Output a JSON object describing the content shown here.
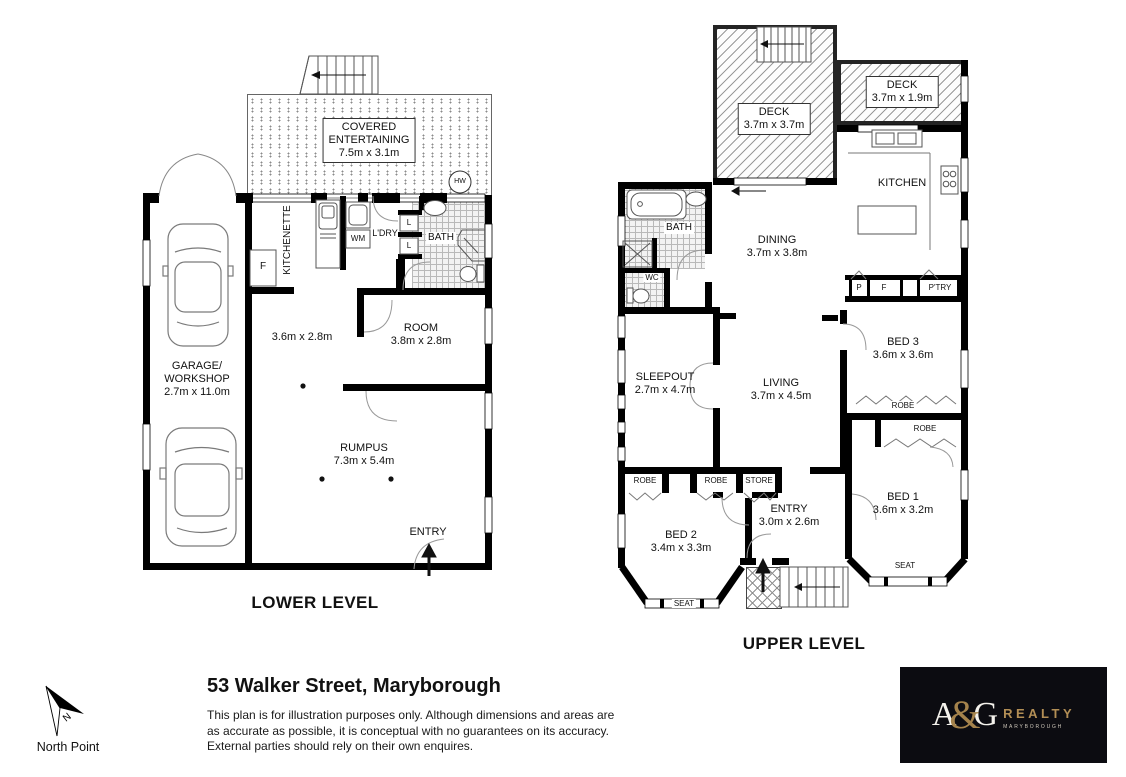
{
  "meta": {
    "address_title": "53 Walker Street, Maryborough"
  },
  "disclaimer": {
    "line1": "This plan is for illustration purposes only.  Although dimensions and areas are",
    "line2": "as accurate as possible, it is conceptual with no guarantees on its accuracy.",
    "line3": "External parties should rely on their own enquires."
  },
  "north": {
    "label": "North Point",
    "letter": "N"
  },
  "logo": {
    "a": "A",
    "amp": "&",
    "g": "G",
    "realty": "REALTY",
    "sub": "MARYBOROUGH"
  },
  "colors": {
    "walls": "#000000",
    "logo_gold": "#b28e55",
    "logo_bg": "#0c0c11"
  },
  "lower": {
    "title": "LOWER LEVEL",
    "covered1": "COVERED",
    "covered2": "ENTERTAINING",
    "covered_dims": "7.5m x 3.1m",
    "hw": "HW",
    "kitchenette": "KITCHENETTE",
    "fridge": "F",
    "wm": "WM",
    "ldry": "L'DRY",
    "linen1": "L",
    "linen2": "L",
    "bath": "BATH",
    "garage1": "GARAGE/",
    "garage2": "WORKSHOP",
    "garage_dims": "2.7m x 11.0m",
    "room1_dims": "3.6m x 2.8m",
    "room2": "ROOM",
    "room2_dims": "3.8m x 2.8m",
    "rumpus": "RUMPUS",
    "rumpus_dims": "7.3m x 5.4m",
    "entry": "ENTRY"
  },
  "upper": {
    "title": "UPPER LEVEL",
    "deck1": "DECK",
    "deck1_dims": "3.7m x 3.7m",
    "deck2": "DECK",
    "deck2_dims": "3.7m x 1.9m",
    "kitchen": "KITCHEN",
    "dining": "DINING",
    "dining_dims": "3.7m x 3.8m",
    "bath": "BATH",
    "wc": "WC",
    "sleepout": "SLEEPOUT",
    "sleepout_dims": "2.7m x 4.7m",
    "living": "LIVING",
    "living_dims": "3.7m x 4.5m",
    "bed3": "BED 3",
    "bed3_dims": "3.6m x 3.6m",
    "bed1": "BED 1",
    "bed1_dims": "3.6m x 3.2m",
    "bed2": "BED 2",
    "bed2_dims": "3.4m x 3.3m",
    "entry": "ENTRY",
    "entry_dims": "3.0m x 2.6m",
    "robe_bed3": "ROBE",
    "robe_bed1": "ROBE",
    "robe_a": "ROBE",
    "robe_b": "ROBE",
    "store": "STORE",
    "p": "P",
    "f": "F",
    "ptry": "P'TRY",
    "seat_bed1": "SEAT",
    "seat_bed2": "SEAT"
  }
}
